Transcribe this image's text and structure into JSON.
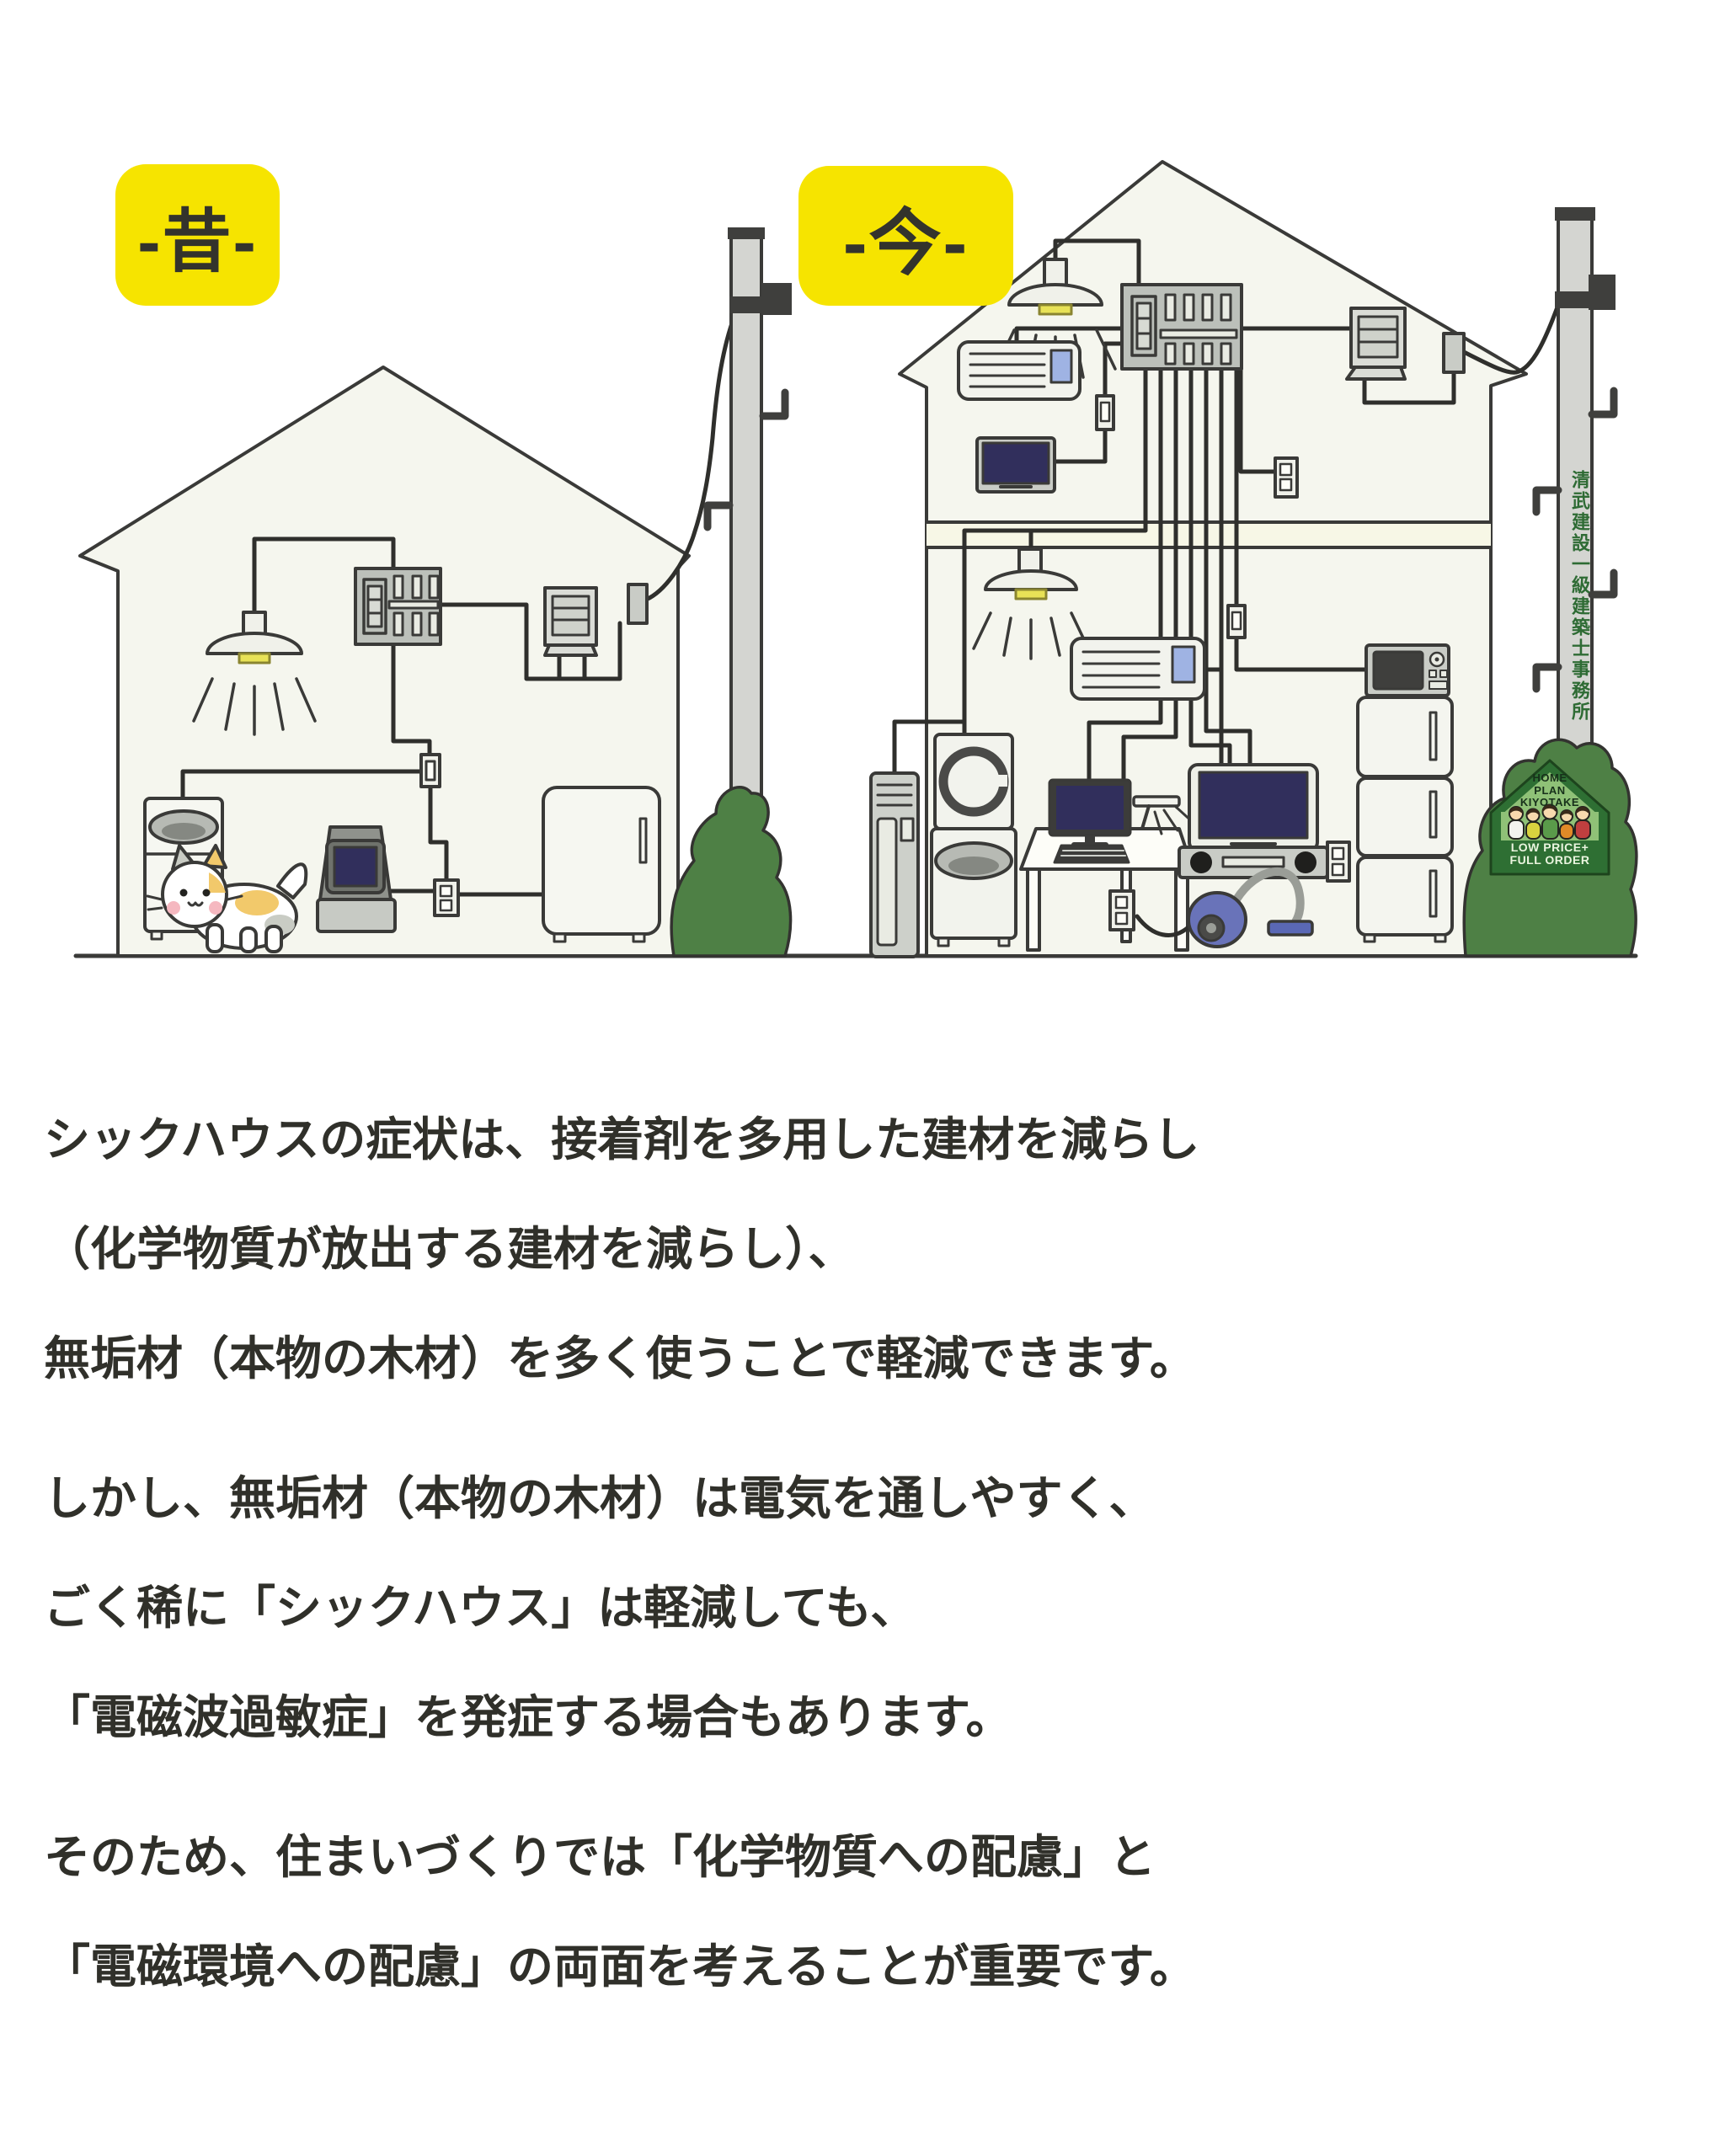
{
  "labels": {
    "past": "-昔-",
    "now": "-今-"
  },
  "utility_pole": {
    "company_sign_vertical": "清武建設一級建築士事務所"
  },
  "kiyotake_sign": {
    "line1": "HOME",
    "line2": "PLAN",
    "line3": "KIYOTAKE",
    "line4": "LOW PRICE+",
    "line5": "FULL ORDER"
  },
  "paragraphs": [
    {
      "lines": [
        "シックハウスの症状は、接着剤を多用した建材を減らし",
        "（化学物質が放出する建材を減らし）、",
        "無垢材（本物の木材）を多く使うことで軽減できます。"
      ]
    },
    {
      "lines": [
        "しかし、無垢材（本物の木材）は電気を通しやすく、",
        "ごく稀に「シックハウス」は軽減しても、",
        "「電磁波過敏症」を発症する場合もあります。"
      ]
    },
    {
      "lines": [
        "そのため、住まいづくりでは「化学物質への配慮」と",
        "「電磁環境への配慮」の両面を考えることが重要です。"
      ]
    }
  ],
  "colors": {
    "label_bg": "#F6E400",
    "house_fill": "#F5F6EE",
    "outline": "#3A3A38",
    "wire": "#2F2F2C",
    "bush_green": "#4E8045",
    "sign_green_dark": "#2E6F33",
    "sign_green_light": "#8FC177",
    "pole_text_green": "#2E6B34",
    "screen_navy": "#312F5C",
    "lamp_yellow": "#E8E257",
    "vacuum_blue": "#6973B9",
    "body_text": "#30302A"
  }
}
